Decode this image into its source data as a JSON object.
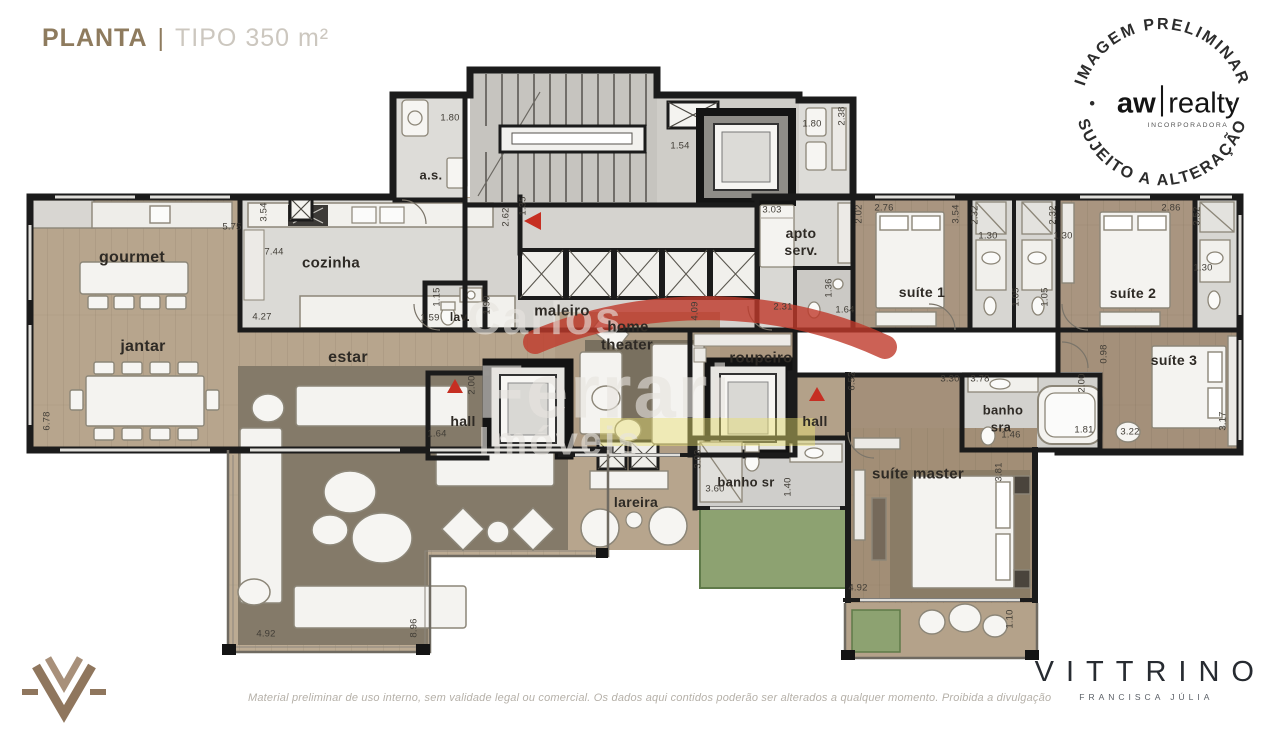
{
  "header": {
    "title_primary": "PLANTA",
    "divider": "|",
    "title_secondary": "TIPO 350 m²"
  },
  "stamp": {
    "arc_top": "IMAGEM PRELIMINAR",
    "arc_bottom": "SUJEITO A ALTERAÇÃO",
    "dot_left": "•",
    "dot_right": "•",
    "brand_left": "aw",
    "brand_right": "realty",
    "brand_sub": "INCORPORADORA"
  },
  "watermark": {
    "line1": "Carlos",
    "line2": "Ferrari",
    "line3": "Imóveis"
  },
  "footer": {
    "disclaimer": "Material preliminar de uso interno, sem validade legal ou comercial. Os dados aqui contidos poderão ser alterados a qualquer momento. Proibida a divulgação",
    "brand": "VITTRINO",
    "brand_sub": "FRANCISCA JÚLIA"
  },
  "plan": {
    "labels": [
      {
        "t": "gourmet",
        "x": 132,
        "y": 258,
        "s": 16
      },
      {
        "t": "jantar",
        "x": 143,
        "y": 347,
        "s": 16
      },
      {
        "t": "cozinha",
        "x": 331,
        "y": 263,
        "s": 15
      },
      {
        "t": "a.s.",
        "x": 431,
        "y": 175,
        "s": 13
      },
      {
        "t": "lav.",
        "x": 460,
        "y": 317,
        "s": 12
      },
      {
        "t": "estar",
        "x": 348,
        "y": 358,
        "s": 16
      },
      {
        "t": "maleiro",
        "x": 562,
        "y": 311,
        "s": 15
      },
      {
        "t": "home",
        "x": 628,
        "y": 327,
        "s": 15
      },
      {
        "t": "theater",
        "x": 627,
        "y": 345,
        "s": 15
      },
      {
        "t": "roupeiro",
        "x": 761,
        "y": 358,
        "s": 15
      },
      {
        "t": "apto",
        "x": 801,
        "y": 233,
        "s": 14
      },
      {
        "t": "serv.",
        "x": 801,
        "y": 250,
        "s": 14
      },
      {
        "t": "suíte 1",
        "x": 922,
        "y": 292,
        "s": 14
      },
      {
        "t": "suíte 2",
        "x": 1133,
        "y": 293,
        "s": 14
      },
      {
        "t": "suíte 3",
        "x": 1174,
        "y": 360,
        "s": 14
      },
      {
        "t": "banho",
        "x": 1003,
        "y": 410,
        "s": 13
      },
      {
        "t": "sra",
        "x": 1001,
        "y": 427,
        "s": 13
      },
      {
        "t": "hall",
        "x": 463,
        "y": 421,
        "s": 14
      },
      {
        "t": "hall",
        "x": 815,
        "y": 421,
        "s": 14
      },
      {
        "t": "banho sr",
        "x": 746,
        "y": 482,
        "s": 13
      },
      {
        "t": "suíte master",
        "x": 918,
        "y": 474,
        "s": 15
      },
      {
        "t": "lareira",
        "x": 636,
        "y": 502,
        "s": 14
      }
    ],
    "dims": [
      {
        "t": "1.80",
        "x": 450,
        "y": 118
      },
      {
        "t": "3.54",
        "x": 264,
        "y": 212,
        "r": 1
      },
      {
        "t": "5.75",
        "x": 232,
        "y": 227
      },
      {
        "t": "7.44",
        "x": 274,
        "y": 252
      },
      {
        "t": "4.27",
        "x": 262,
        "y": 317
      },
      {
        "t": "6.78",
        "x": 47,
        "y": 421,
        "r": 1
      },
      {
        "t": "2.62",
        "x": 506,
        "y": 217,
        "r": 1
      },
      {
        "t": "1.35",
        "x": 523,
        "y": 206,
        "r": 1
      },
      {
        "t": "1.15",
        "x": 437,
        "y": 297,
        "r": 1
      },
      {
        "t": "1.59",
        "x": 430,
        "y": 318
      },
      {
        "t": "1.90",
        "x": 487,
        "y": 305,
        "r": 1
      },
      {
        "t": "3.03",
        "x": 772,
        "y": 210
      },
      {
        "t": "1.54",
        "x": 680,
        "y": 146
      },
      {
        "t": "2.02",
        "x": 859,
        "y": 214,
        "r": 1
      },
      {
        "t": "2.76",
        "x": 884,
        "y": 208
      },
      {
        "t": "1.80",
        "x": 812,
        "y": 124
      },
      {
        "t": "2.38",
        "x": 842,
        "y": 116,
        "r": 1
      },
      {
        "t": "2.31",
        "x": 783,
        "y": 307
      },
      {
        "t": "1.36",
        "x": 829,
        "y": 288,
        "r": 1
      },
      {
        "t": "1.64",
        "x": 845,
        "y": 310
      },
      {
        "t": "2.32",
        "x": 975,
        "y": 215,
        "r": 1
      },
      {
        "t": "2.32",
        "x": 1053,
        "y": 215,
        "r": 1
      },
      {
        "t": "3.54",
        "x": 956,
        "y": 214,
        "r": 1
      },
      {
        "t": "1.30",
        "x": 988,
        "y": 236
      },
      {
        "t": "1.30",
        "x": 1063,
        "y": 236
      },
      {
        "t": "1.05",
        "x": 1016,
        "y": 297,
        "r": 1
      },
      {
        "t": "1.05",
        "x": 1045,
        "y": 297,
        "r": 1
      },
      {
        "t": "2.86",
        "x": 1171,
        "y": 208
      },
      {
        "t": "3.52",
        "x": 1197,
        "y": 216,
        "r": 1
      },
      {
        "t": "1.30",
        "x": 1203,
        "y": 268
      },
      {
        "t": "0.98",
        "x": 1104,
        "y": 354,
        "r": 1
      },
      {
        "t": "3.30",
        "x": 950,
        "y": 379
      },
      {
        "t": "3.78",
        "x": 980,
        "y": 379
      },
      {
        "t": "2.00",
        "x": 1082,
        "y": 383,
        "r": 1
      },
      {
        "t": "1.46",
        "x": 1011,
        "y": 435
      },
      {
        "t": "1.81",
        "x": 1084,
        "y": 430
      },
      {
        "t": "3.22",
        "x": 1130,
        "y": 432
      },
      {
        "t": "3.17",
        "x": 1223,
        "y": 421,
        "r": 1
      },
      {
        "t": "6.52",
        "x": 852,
        "y": 381,
        "r": 1
      },
      {
        "t": "2.00",
        "x": 472,
        "y": 385,
        "r": 1
      },
      {
        "t": "1.64",
        "x": 437,
        "y": 434
      },
      {
        "t": "4.09",
        "x": 695,
        "y": 311,
        "r": 1
      },
      {
        "t": "3.03",
        "x": 698,
        "y": 459,
        "r": 1
      },
      {
        "t": "3.60",
        "x": 715,
        "y": 489
      },
      {
        "t": "1.40",
        "x": 788,
        "y": 487,
        "r": 1
      },
      {
        "t": "4.92",
        "x": 858,
        "y": 588
      },
      {
        "t": "1.10",
        "x": 1010,
        "y": 619,
        "r": 1
      },
      {
        "t": "3.81",
        "x": 999,
        "y": 472,
        "r": 1
      },
      {
        "t": "4.92",
        "x": 266,
        "y": 634
      },
      {
        "t": "8.96",
        "x": 414,
        "y": 628,
        "r": 1
      }
    ]
  }
}
